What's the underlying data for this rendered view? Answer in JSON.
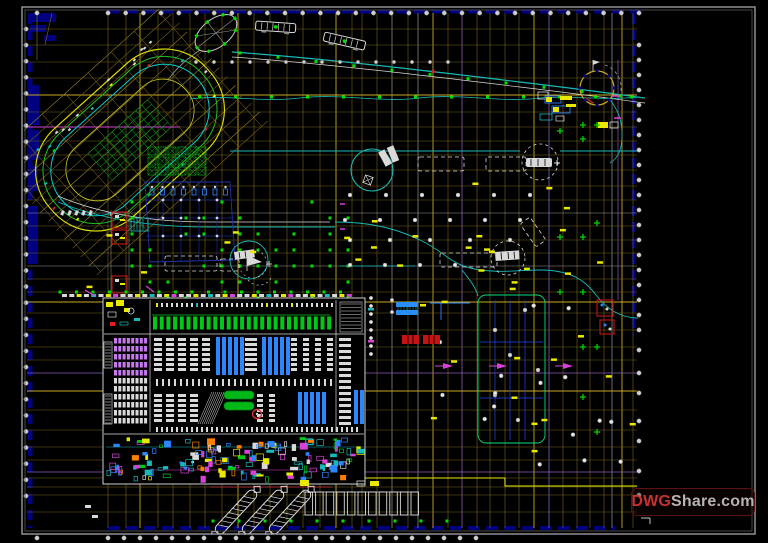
{
  "watermark": {
    "brand_prefix": "DWG",
    "brand_suffix": "Share.com",
    "full_text": "DWGShare.com"
  },
  "palette": {
    "bg": "#000000",
    "frame": "#9a9a9a",
    "frameInner": "#5a5a5a",
    "gridOlive": "#7a651a",
    "gridBright": "#c9a91e",
    "gridGray": "#9a9a9a",
    "violet": "#8a5ab8",
    "navy": "#000080",
    "cyan": "#17b9b9",
    "green": "#00c818",
    "greenDot": "#00e000",
    "blue": "#2e86ff",
    "plum": "#c878f0",
    "magenta": "#d840d8",
    "yellow": "#e8e800",
    "white": "#d9d9d9",
    "red": "#cc2222",
    "watermark_red": "#c83232",
    "watermark_gray": "#b5b5b5"
  }
}
